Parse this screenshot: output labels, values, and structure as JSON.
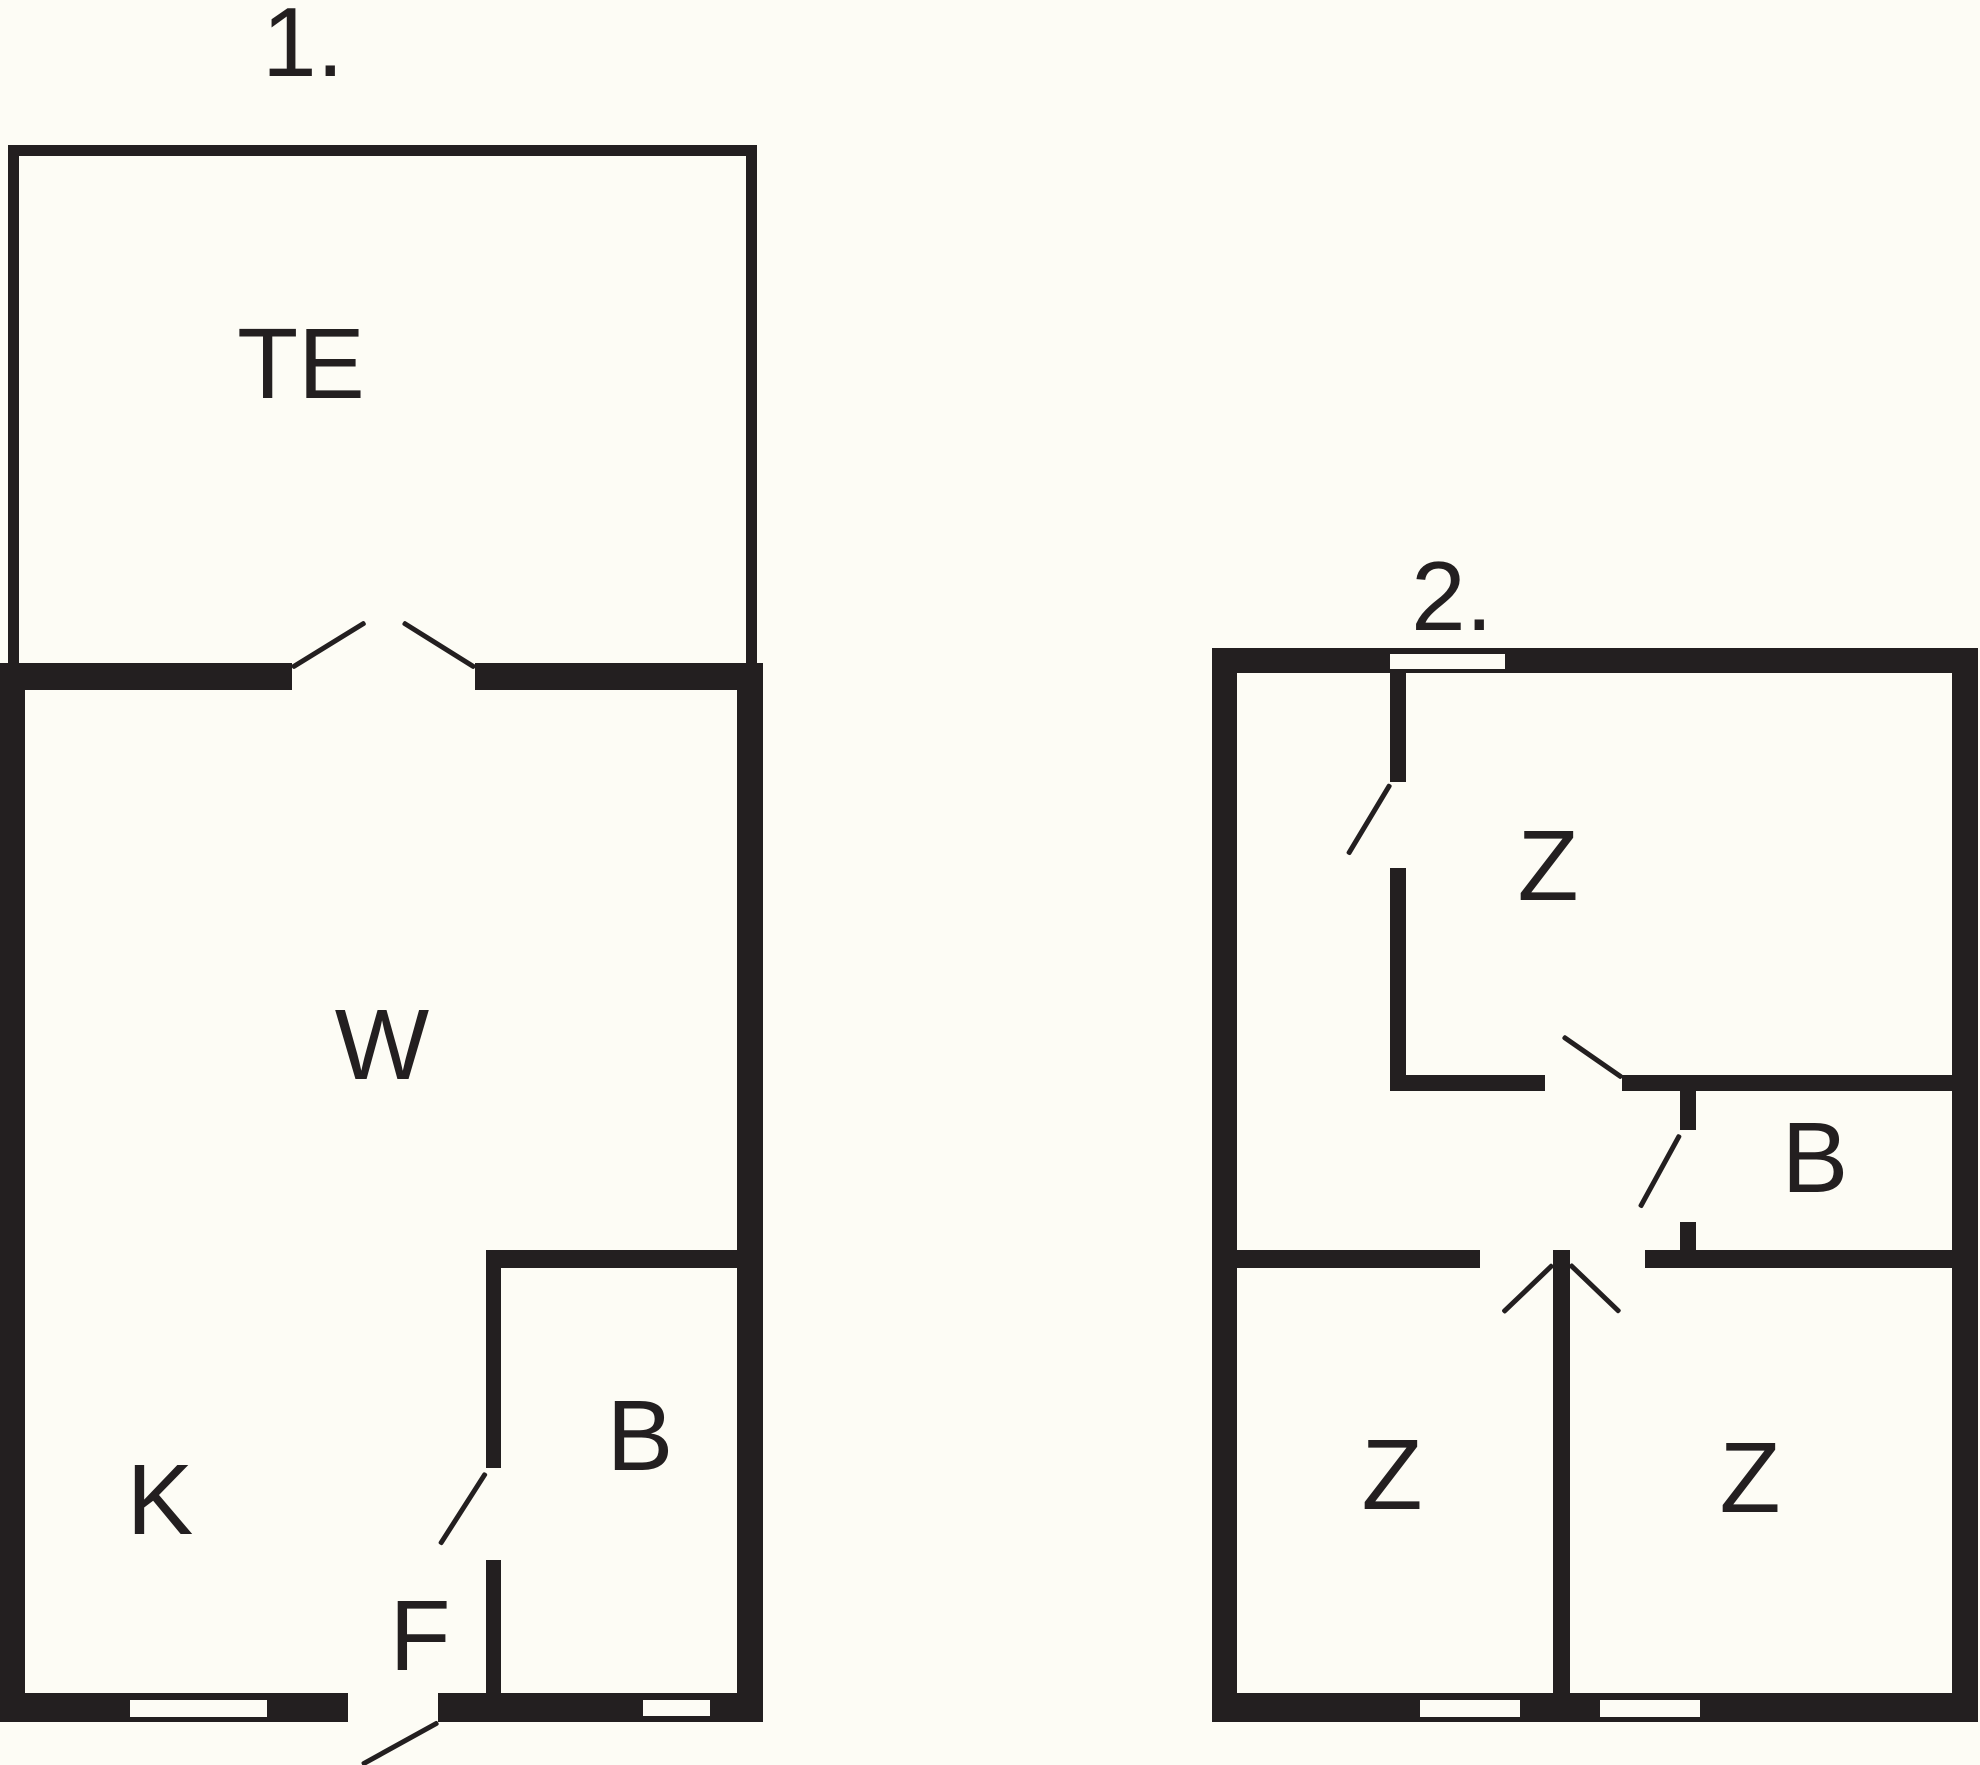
{
  "colors": {
    "ink": "#231F20",
    "paper": "#FDFCF5"
  },
  "plans": [
    {
      "number": "1.",
      "rooms": [
        {
          "label": "TE"
        },
        {
          "label": "W"
        },
        {
          "label": "K"
        },
        {
          "label": "F"
        },
        {
          "label": "B"
        }
      ]
    },
    {
      "number": "2.",
      "rooms": [
        {
          "label": "Z"
        },
        {
          "label": "B"
        },
        {
          "label": "Z"
        },
        {
          "label": "Z"
        }
      ]
    }
  ]
}
